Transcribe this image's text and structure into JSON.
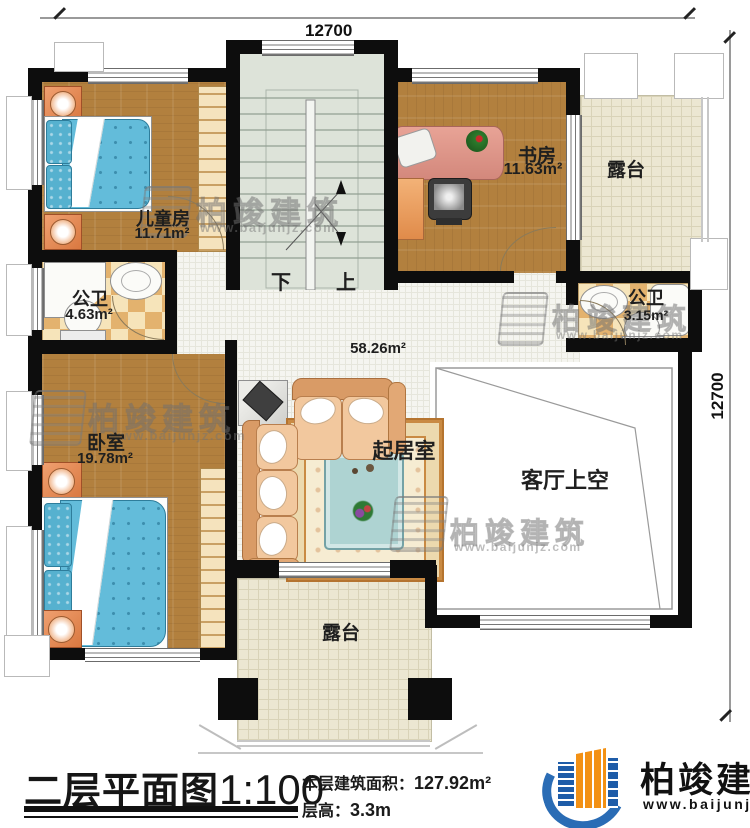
{
  "plan": {
    "title": "二层平面图",
    "scale": "1:100",
    "building_area_label": "本层建筑面积：",
    "building_area_value": "127.92m²",
    "floor_height_label": "层高：",
    "floor_height_value": "3.3m"
  },
  "dimensions": {
    "top": "12700",
    "right": "12700"
  },
  "rooms": {
    "children_room": {
      "name": "儿童房",
      "area": "11.71m²"
    },
    "study": {
      "name": "书房",
      "area": "11.63m²"
    },
    "terrace_top": {
      "name": "露台"
    },
    "bath_left": {
      "name": "公卫",
      "area": "4.63m²"
    },
    "bath_right": {
      "name": "公卫",
      "area": "3.15m²"
    },
    "bedroom": {
      "name": "卧室",
      "area": "19.78m²"
    },
    "living": {
      "name": "起居室",
      "area": "58.26m²"
    },
    "void_above_living": {
      "name": "客厅上空"
    },
    "terrace_bottom": {
      "name": "露台"
    }
  },
  "stairs": {
    "down": "下",
    "up": "上"
  },
  "brand": {
    "name": "柏竣建筑",
    "url": "www.baijunjz.com"
  }
}
